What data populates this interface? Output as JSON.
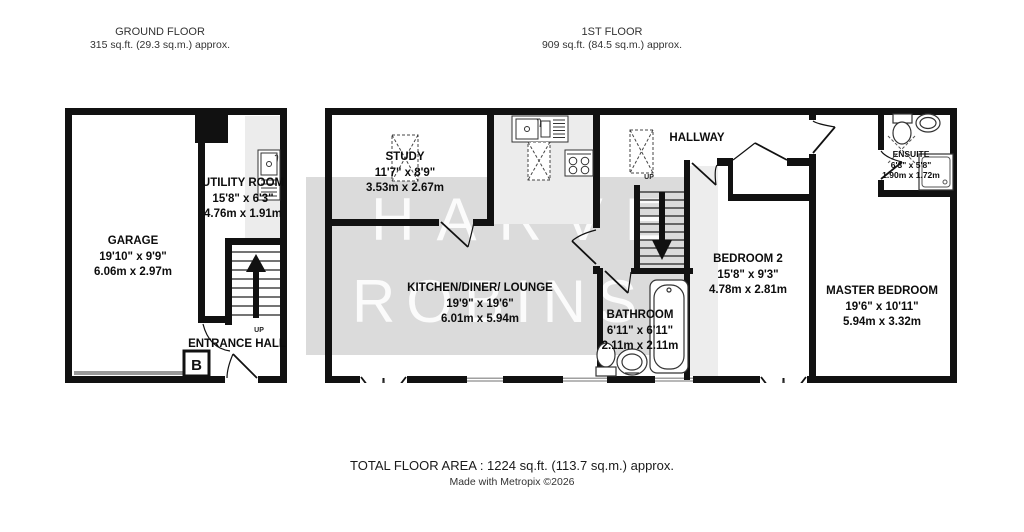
{
  "floors": {
    "ground": {
      "title": "GROUND FLOOR",
      "area": "315 sq.ft. (29.3 sq.m.) approx."
    },
    "first": {
      "title": "1ST FLOOR",
      "area": "909 sq.ft. (84.5 sq.m.) approx."
    }
  },
  "rooms": {
    "garage": {
      "name": "GARAGE",
      "imperial": "19'10\" x 9'9\"",
      "metric": "6.06m x 2.97m"
    },
    "utility_room": {
      "name": "UTILITY ROOM",
      "imperial": "15'8\" x 6'3\"",
      "metric": "4.76m x 1.91m"
    },
    "entrance_hall": {
      "name": "ENTRANCE HALL"
    },
    "study": {
      "name": "STUDY",
      "imperial": "11'7\" x 8'9\"",
      "metric": "3.53m x 2.67m"
    },
    "kitchen_diner_lounge": {
      "name": "KITCHEN/DINER/ LOUNGE",
      "imperial": "19'9\" x 19'6\"",
      "metric": "6.01m x 5.94m"
    },
    "hallway": {
      "name": "HALLWAY"
    },
    "bathroom": {
      "name": "BATHROOM",
      "imperial": "6'11\" x 6'11\"",
      "metric": "2.11m x 2.11m"
    },
    "bedroom_2": {
      "name": "BEDROOM 2",
      "imperial": "15'8\" x 9'3\"",
      "metric": "4.78m x 2.81m"
    },
    "master_bedroom": {
      "name": "MASTER BEDROOM",
      "imperial": "19'6\" x 10'11\"",
      "metric": "5.94m x 3.32m"
    },
    "ensuite": {
      "name": "ENSUITE",
      "imperial": "6'3\" x 5'8\"",
      "metric": "1.90m x 1.72m"
    }
  },
  "annotations": {
    "up_ground": "UP",
    "up_first": "UP",
    "boiler": "B"
  },
  "watermark": {
    "line1": "HARVEY",
    "line2": "ROBINSON"
  },
  "footer": {
    "total_area": "TOTAL FLOOR AREA : 1224 sq.ft. (113.7 sq.m.) approx.",
    "credit": "Made with Metropix ©2026"
  },
  "colors": {
    "wall": "#111111",
    "room_shading": "#ececec",
    "watermark_box": "rgba(190,190,190,0.55)",
    "watermark_text": "rgba(255,255,255,0.88)",
    "garage_door": "#999999"
  }
}
